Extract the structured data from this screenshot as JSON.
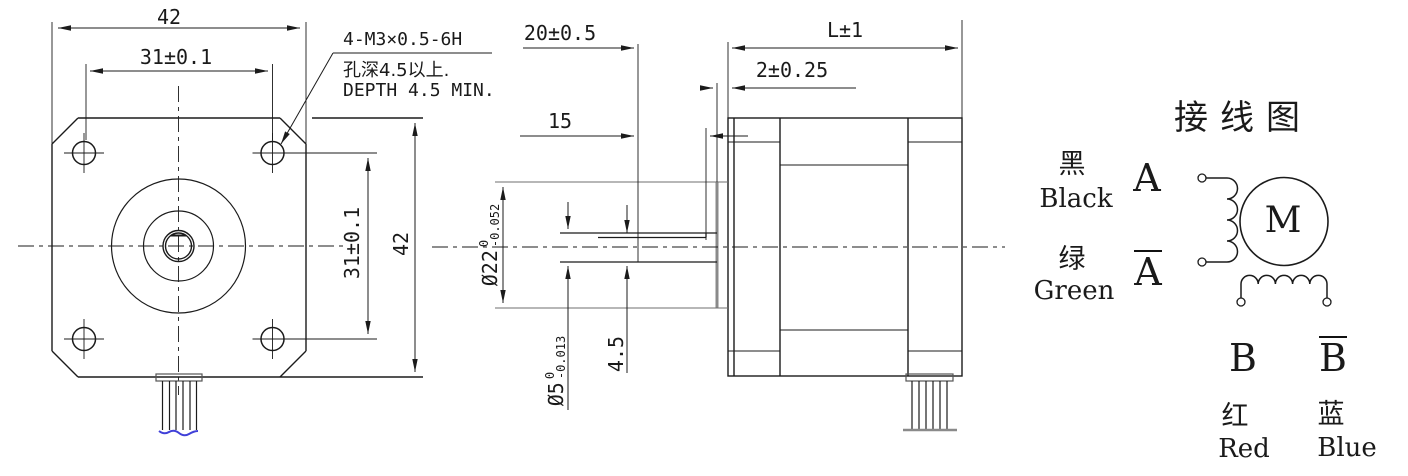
{
  "drawing": {
    "front_view": {
      "dim_width_top": "42",
      "dim_hole_spacing_top": "31±0.1",
      "dim_hole_spacing_right": "31±0.1",
      "dim_height_right": "42",
      "tap_note_line1": "4-M3×0.5-6H",
      "tap_note_line2": "孔深4.5以上.",
      "tap_note_line3": "DEPTH 4.5 MIN."
    },
    "side_view": {
      "dim_shaft_extension": "20±0.5",
      "dim_body_length": "L±1",
      "dim_boss_height": "2±0.25",
      "dim_flat_length": "15",
      "dim_boss_diameter_prefix": "Ø22",
      "dim_boss_diameter_upper": "0",
      "dim_boss_diameter_lower": "-0.052",
      "dim_shaft_diameter_prefix": "Ø5",
      "dim_shaft_diameter_upper": "0",
      "dim_shaft_diameter_lower": "-0.013",
      "dim_flat_height": "4.5"
    },
    "wiring_diagram": {
      "title": "接线图",
      "motor_symbol": "M",
      "lead_a": {
        "color_cn": "黑",
        "color_en": "Black",
        "terminal": "A"
      },
      "lead_a_bar": {
        "color_cn": "绿",
        "color_en": "Green",
        "terminal": "A"
      },
      "lead_b": {
        "color_cn": "红",
        "color_en": "Red",
        "terminal": "B"
      },
      "lead_b_bar": {
        "color_cn": "蓝",
        "color_en": "Blue",
        "terminal": "B"
      }
    },
    "colors": {
      "line": "#1b1b1b",
      "gray_line": "#8a8a8a",
      "wire_tip_blue": "#4040d8"
    }
  }
}
